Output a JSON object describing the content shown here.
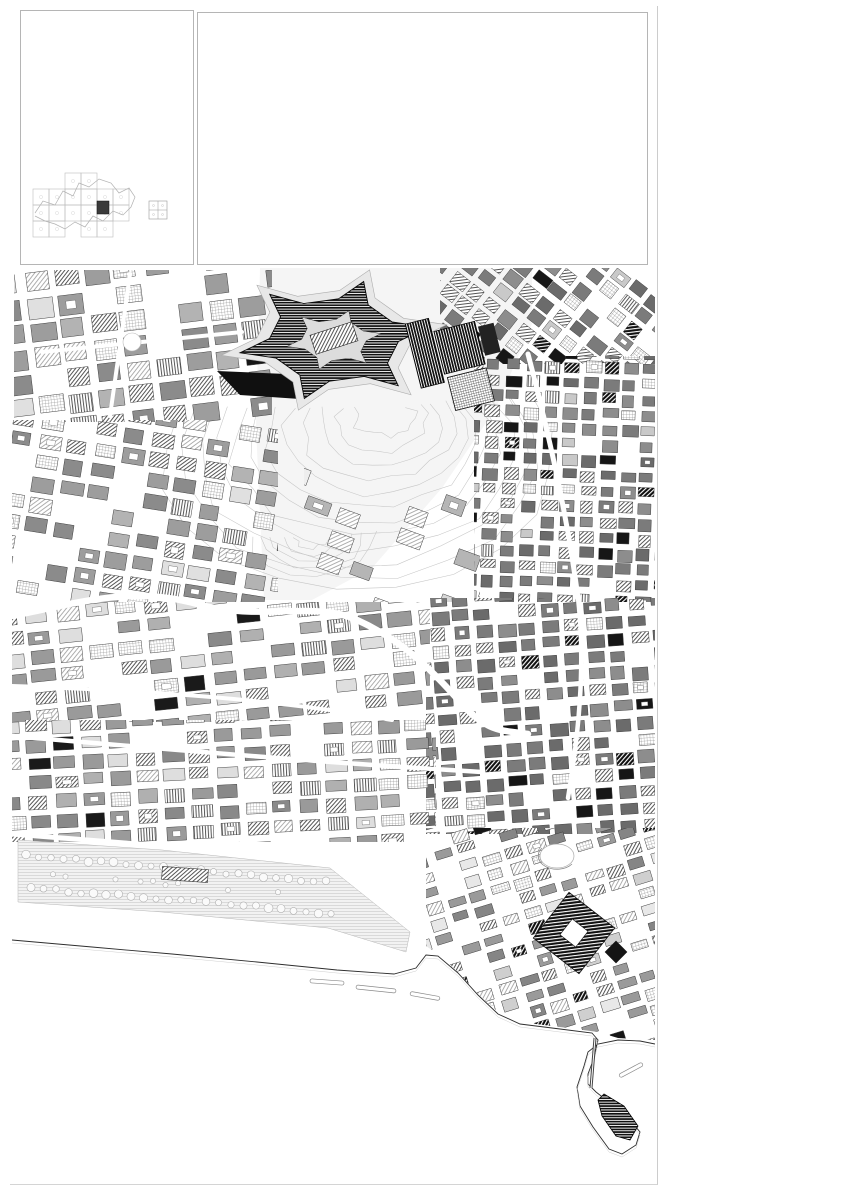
{
  "colors": {
    "paper": "#ffffff",
    "ink": "#1a1a1a",
    "legend_text": "#8d8d8d"
  },
  "title_block": {
    "org": "Comune di Napoli",
    "org_sub1": "assessorato alla vivibilità",
    "org_sub2": "servizio pianificazione urbanistica",
    "plan_title": "Variante al piano regolatore generale",
    "plan_subtitle": "centro storico, zona orientale, zona nordoccidentale",
    "sheet_label": "TAV. 7",
    "sheet_title": "Centro storico - classificazione tipologica",
    "sheet_note": "con modifiche in accoglimento delle osservazioni",
    "folio": "foglio n. 14 III",
    "scale": "rapp. 1:2.000",
    "signature_role": "Il dirigente",
    "signature_name": "Roberto Giannì",
    "date": "gennaio 2004"
  },
  "legend": {
    "columns": [
      {
        "groups": [
          {
            "header": "UNITA' EDILIZIE DI BASE PREOTTOCENTESCHE",
            "items": [
              {
                "swatch": "solid-dark",
                "label": "originarie o di ristrutturazione a corte"
              },
              {
                "swatch": "diag-dark",
                "label": "originarie o di ristrutturazione a blocco"
              },
              {
                "swatch": "vstripe-dark",
                "label": "originarie o di ristrutturazione a struttura autonoma"
              }
            ]
          },
          {
            "header": "UNITA' EDILIZIE DI BASE OTTOCENTESCHE",
            "items": [
              {
                "swatch": "diag-fine",
                "label": "originarie o di ristrutturazione a corte"
              },
              {
                "swatch": "diag-med",
                "label": "originarie o di ristrutturazione a blocco"
              },
              {
                "swatch": "vstripe-med",
                "label": "originarie o di ristrutturazione a struttura autonoma"
              }
            ]
          },
          {
            "header": "UNITA' EDILIZIE DI BASE OTTO/NOVECENTESCHE E NOVECENTESCHE",
            "items": [
              {
                "swatch": "solid-light",
                "label": "originarie o di ristrutturazione a corte"
              },
              {
                "swatch": "diag-light",
                "label": "originarie o di ristrutturazione a blocco"
              },
              {
                "swatch": "vstripe-light",
                "label": "originarie o di ristrutturazione a struttura autonoma"
              }
            ]
          }
        ]
      },
      {
        "groups": [
          {
            "header": "UNITA' EDILIZIE SPECIALI PREOTTOCENTESCHE",
            "items": [
              {
                "swatch": "k-line",
                "label": "a struttura unitaria"
              },
              {
                "swatch": "k-diag",
                "label": "a struttura modulare"
              },
              {
                "swatch": "k-complex",
                "label": "a struttura complessa"
              },
              {
                "swatch": "k-hstripe",
                "label": "a struttura singolare non ripetuta"
              }
            ]
          },
          {
            "header": "UNITA' EDILIZIE SPECIALI OTTOCENTESCHE",
            "items": [
              {
                "swatch": "m-line",
                "label": "originarie o di ristrutturazione a struttura unitaria"
              },
              {
                "swatch": "m-diag",
                "label": "originarie o di ristrutturazione a struttura modulare"
              },
              {
                "swatch": "m-vstripe",
                "label": "originarie o di ristrutturazione a struttura modulare complessa"
              },
              {
                "swatch": "m-hstripe",
                "label": "a struttura singolare non ripetuta"
              }
            ]
          },
          {
            "header": "UNITA' EDILIZIE SPECIALI OTTO/NOVECENTESCHE",
            "items": [
              {
                "swatch": "l-solid",
                "label": "originarie o di ristrutturazione a struttura unitaria"
              },
              {
                "swatch": "l-diag",
                "label": "originarie o di ristrutturazione a struttura modulare"
              },
              {
                "swatch": "l-vstripe",
                "label": "originarie o di ristrutturazione a struttura modulare complessa"
              },
              {
                "swatch": "l-hstripe",
                "label": "a struttura singolare non ripetuta"
              }
            ]
          }
        ]
      },
      {
        "groups": [
          {
            "header": "UNITA' DI SPAZIO SCOPERTO CONCLUSE RELATIVE A UNITA' EDILIZIE DI BASE",
            "items": [
              {
                "swatch": "grid-fine",
                "label": "giardini, orti e spazi pavimentati pertinenti a unità edilizie di base"
              },
              {
                "swatch": "diag-sparse",
                "label": "spazi residuali della originaria morfologia relativi all'edificazione di base"
              }
            ]
          },
          {
            "header": "UNITA' DI SPAZIO SCOPERTO CONCLUSE, SPECIALI O RELATIVE A UNITA' EDILIZIE SPECIALI",
            "items": [
              {
                "swatch": "pale",
                "label": "parchi e giardini a struttura autonoma"
              },
              {
                "swatch": "grid-dense",
                "label": "chiostri/giardino pertinenti a unità edilizie speciali modulari o modulari complesse"
              },
              {
                "swatch": "grid-open",
                "label": "chiostri pavimentati pertinenti a unità edilizie speciali modulari o modulari complesse"
              },
              {
                "swatch": "solid-mid",
                "label": "spazi dell'originaria morfologia pertinenti a unità edilizie speciali"
              },
              {
                "swatch": "hlines",
                "label": "giardini, corti e altre aree pavimentate pertinenti a unità edilizie speciali, modulari o modulari complesse"
              },
              {
                "swatch": "cross-light",
                "label": "giardini pertinenti a unità edilizie speciali a impianto singolare o non ripetuto"
              },
              {
                "swatch": "cross-dot",
                "label": "corti e aree pavimentate pertinenti a unità edilizie speciali a impianto singolare e non ripetuto"
              }
            ]
          },
          {
            "header": "ALTRE UNITA' DI SPAZIO",
            "items": [
              {
                "swatch": "mixed-dark",
                "label": "unità di spazio scoperte non concluse"
              },
              {
                "swatch": "grid-gray",
                "label": "unità edilizie di recente formazione"
              },
              {
                "swatch": "hstripe-gray",
                "label": "ruderi o sedimi risultanti da demolizioni"
              },
              {
                "swatch": "asterisk",
                "label": "cantieri in corso"
              }
            ]
          }
        ]
      }
    ],
    "boundary_item": {
      "swatch": "boundary",
      "label": "confine del centro storico"
    },
    "asterisk_glyph": "✳"
  }
}
